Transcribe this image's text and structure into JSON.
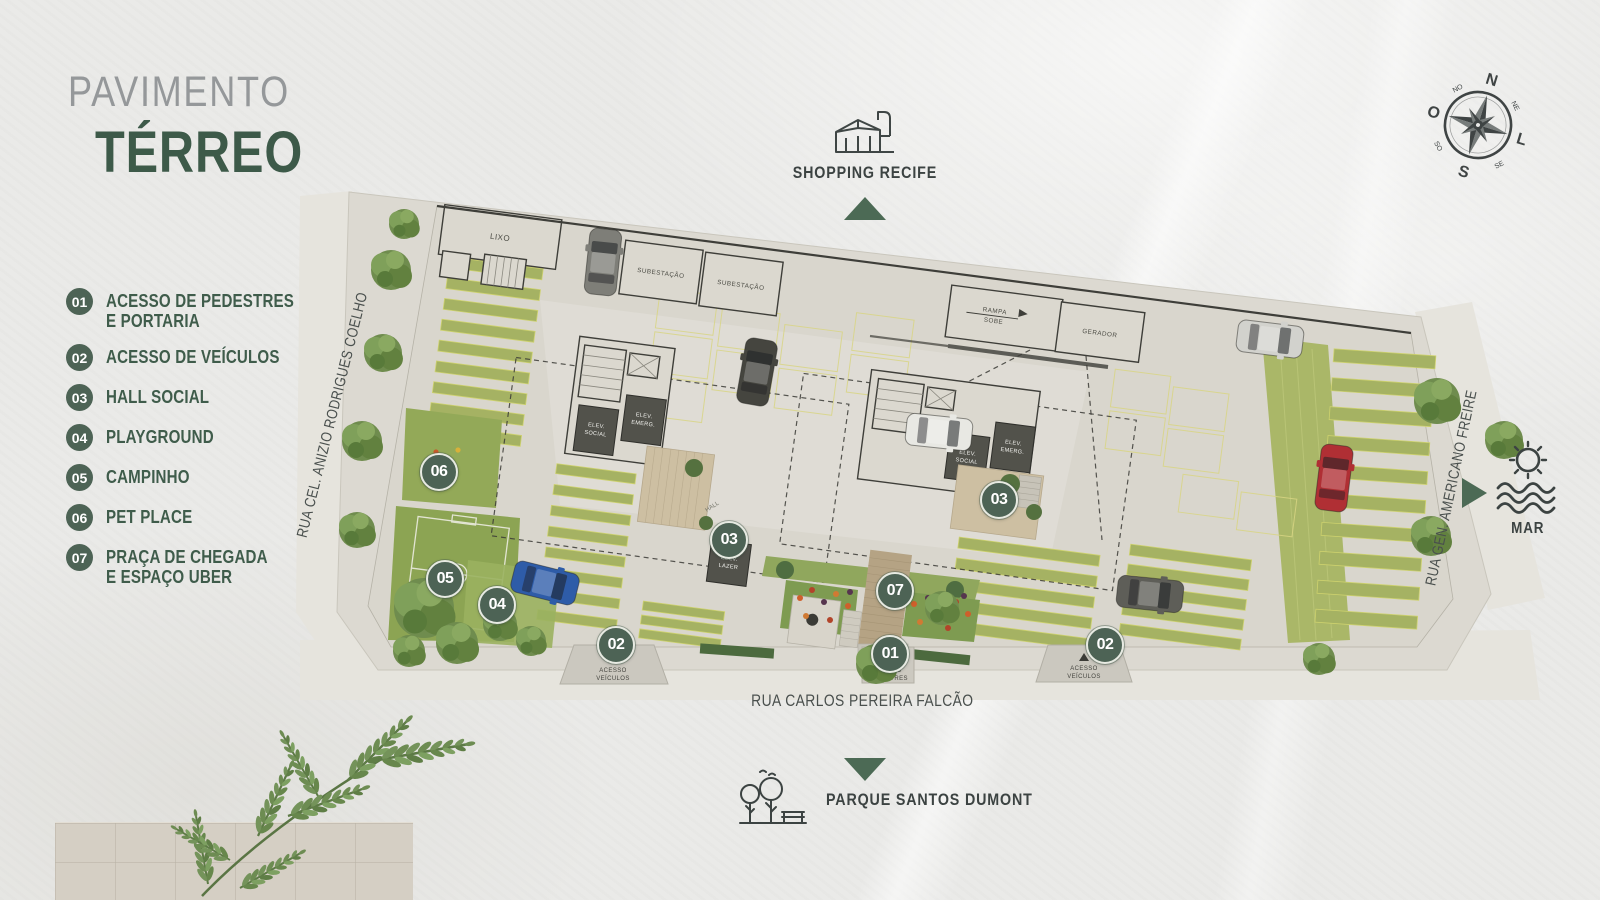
{
  "title": {
    "line1": "PAVIMENTO",
    "line2": "TÉRREO"
  },
  "legend": {
    "items": [
      {
        "num": "01",
        "line1": "ACESSO DE PEDESTRES",
        "line2": "E PORTARIA"
      },
      {
        "num": "02",
        "line1": "ACESSO DE VEÍCULOS",
        "line2": ""
      },
      {
        "num": "03",
        "line1": "HALL SOCIAL",
        "line2": ""
      },
      {
        "num": "04",
        "line1": "PLAYGROUND",
        "line2": ""
      },
      {
        "num": "05",
        "line1": "CAMPINHO",
        "line2": ""
      },
      {
        "num": "06",
        "line1": "PET PLACE",
        "line2": ""
      },
      {
        "num": "07",
        "line1": "PRAÇA DE CHEGADA",
        "line2": "E ESPAÇO UBER"
      }
    ]
  },
  "landmarks": {
    "shopping": "SHOPPING RECIFE",
    "parque": "PARQUE SANTOS DUMONT",
    "mar": "MAR"
  },
  "streets": {
    "left": "RUA CEL. ANIZIO RODRIGUES COELHO",
    "right": "RUA GEN. AMERICANO FREIRE",
    "bottom": "RUA CARLOS PEREIRA FALCÃO"
  },
  "compass": {
    "n": "N",
    "s": "S",
    "o": "O",
    "l": "L",
    "no": "NO",
    "ne": "NE",
    "se": "SE",
    "so": "SO"
  },
  "plan": {
    "badges": {
      "b1": "01",
      "b2": "02",
      "b3": "03",
      "b4": "04",
      "b5": "05",
      "b6": "06",
      "b7": "07"
    },
    "labels": {
      "lixo": "LIXO",
      "subestacao": "SUBESTAÇÃO",
      "rampa": "RAMPA",
      "sobe": "SOBE",
      "gerador": "GERADOR",
      "hall": "HALL",
      "elev": "ELEV.",
      "social": "SOCIAL",
      "emerg": "EMERG.",
      "lazer": "LAZER",
      "acesso": "ACESSO",
      "veiculos": "VEÍCULOS",
      "pedestres": "PEDESTRES"
    }
  },
  "colors": {
    "accent_green": "#4d6355",
    "triangle_green": "#4c6a55",
    "legend_green": "#3f5c4b",
    "title_gray": "#95989a",
    "ink": "#3c4342",
    "stripe_green": "#a5b263",
    "slab_beige": "#d9d6cd"
  }
}
